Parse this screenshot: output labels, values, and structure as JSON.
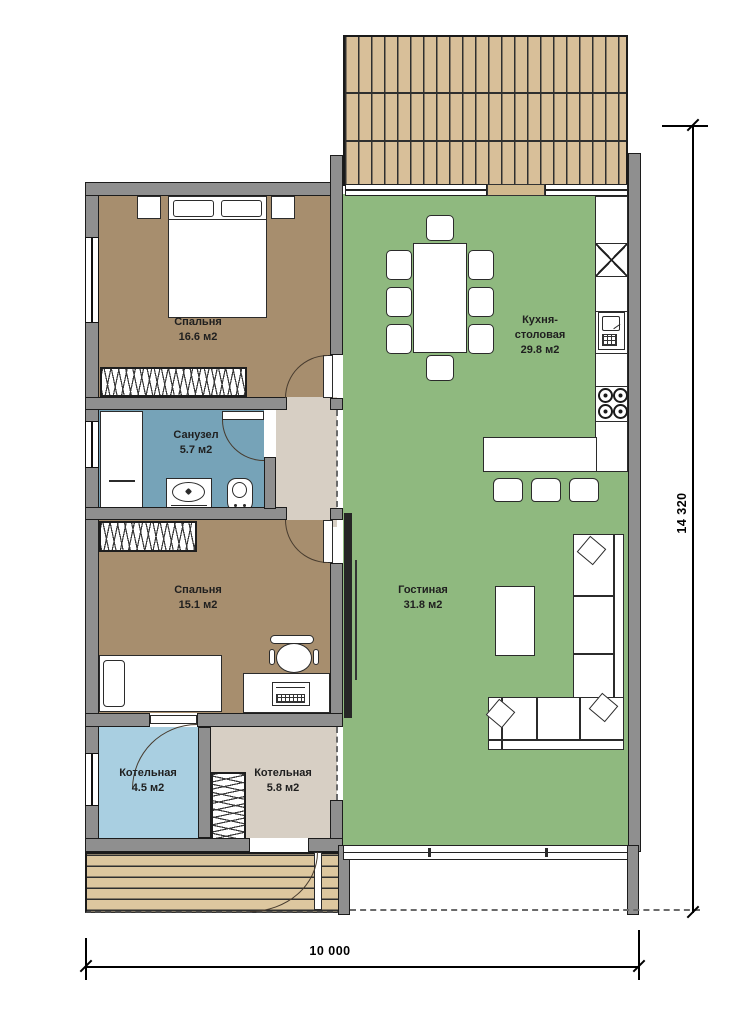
{
  "plan_title": "floor-plan",
  "rooms": {
    "bedroom1": {
      "label": "Спальня",
      "area": "16.6 м2"
    },
    "kitchen": {
      "label_line1": "Кухня-",
      "label_line2": "столовая",
      "area": "29.8 м2"
    },
    "bathroom": {
      "label": "Санузел",
      "area": "5.7 м2"
    },
    "bedroom2": {
      "label": "Спальня",
      "area": "15.1 м2"
    },
    "living": {
      "label": "Гостиная",
      "area": "31.8 м2"
    },
    "boiler1": {
      "label": "Котельная",
      "area": "4.5 м2"
    },
    "boiler2": {
      "label": "Котельная",
      "area": "5.8 м2"
    }
  },
  "dimensions": {
    "vertical": "14 320",
    "horizontal": "10 000"
  },
  "colors": {
    "wall": "#8f8f8f",
    "bedroom_fill": "#a78e6e",
    "living_fill": "#8fb97f",
    "bathroom_fill": "#76a3b8",
    "boiler_fill": "#a9cfe1",
    "hall_fill": "#d7cfc4",
    "deck_wood": "#d8bf99",
    "door_sill": "#d2b98e",
    "outline": "#1c1c1c"
  }
}
